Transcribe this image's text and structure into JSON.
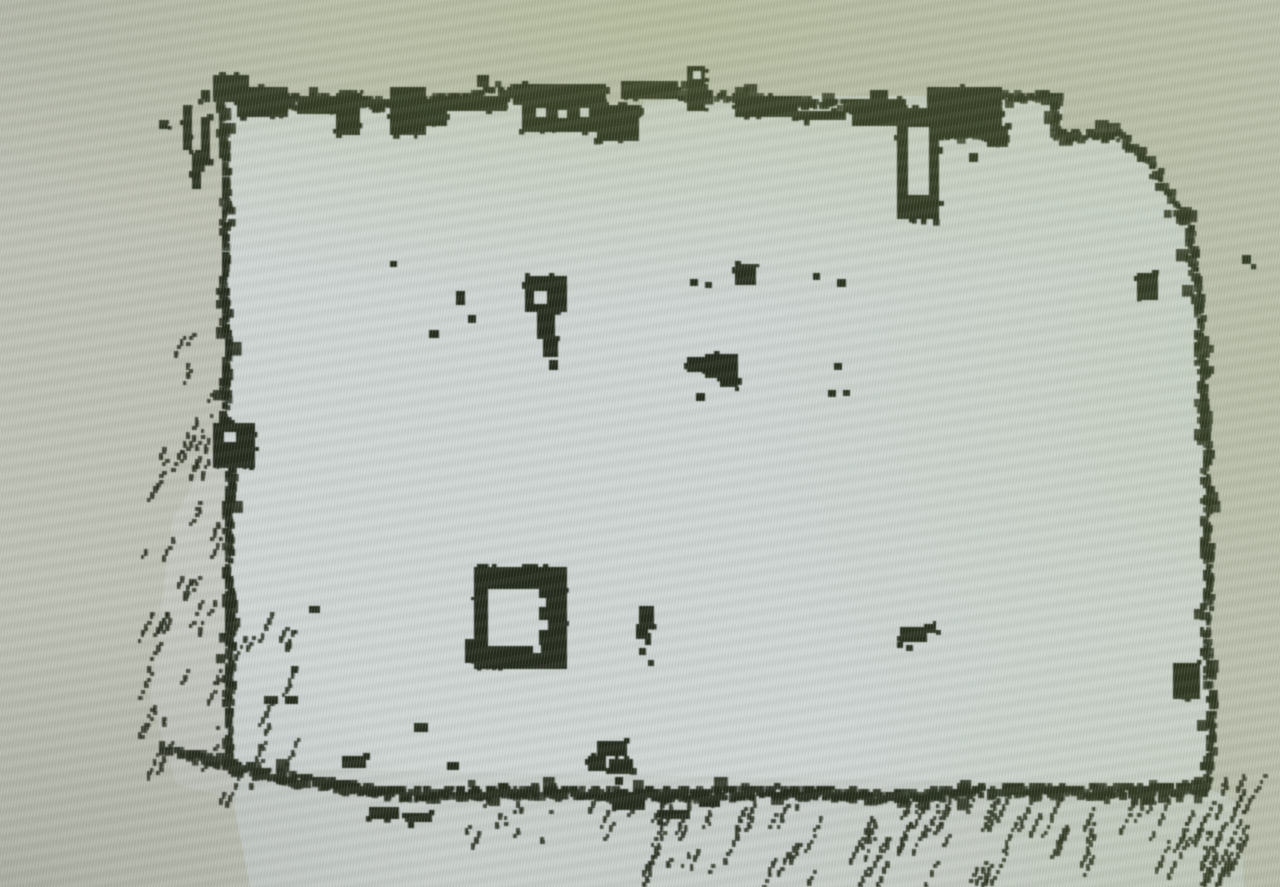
{
  "scene": {
    "kind": "photograph of a monitor showing a lidar occupancy-grid map",
    "visible_text": []
  },
  "map": {
    "width": 1280,
    "height": 887,
    "seed": 11,
    "colors": {
      "unknown": "#bfc2b6",
      "free_main": "#cfd6d4",
      "free_dim": "#c9cfcb",
      "wedge": "#c6c9c2",
      "obstacle": "#232a1b"
    },
    "free_regions": [
      {
        "name": "room-interior",
        "color": "free_main",
        "points": [
          [
            227,
            98
          ],
          [
            644,
            104
          ],
          [
            688,
            96
          ],
          [
            1004,
            96
          ],
          [
            1062,
            94
          ],
          [
            1062,
            132
          ],
          [
            1122,
            136
          ],
          [
            1152,
            170
          ],
          [
            1191,
            232
          ],
          [
            1203,
            340
          ],
          [
            1207,
            520
          ],
          [
            1211,
            700
          ],
          [
            1207,
            788
          ],
          [
            560,
            780
          ],
          [
            232,
            768
          ],
          [
            225,
            430
          ],
          [
            223,
            230
          ]
        ]
      },
      {
        "name": "below-wall-strip",
        "color": "free_dim",
        "points": [
          [
            230,
            768
          ],
          [
            1205,
            786
          ],
          [
            1240,
            804
          ],
          [
            1244,
            887
          ],
          [
            250,
            887
          ],
          [
            234,
            806
          ]
        ]
      },
      {
        "name": "left-seen-wedge",
        "color": "wedge",
        "points": [
          [
            225,
            428
          ],
          [
            232,
            770
          ],
          [
            237,
            800
          ],
          [
            176,
            784
          ],
          [
            150,
            696
          ],
          [
            172,
            520
          ]
        ]
      }
    ],
    "walls": [
      {
        "name": "top-wall-west",
        "thickness": 13,
        "points": [
          [
            222,
            96
          ],
          [
            262,
            94
          ],
          [
            302,
            104
          ],
          [
            346,
            99
          ],
          [
            402,
            110
          ],
          [
            456,
            99
          ],
          [
            518,
            93
          ],
          [
            556,
            116
          ],
          [
            602,
            120
          ],
          [
            642,
            112
          ]
        ]
      },
      {
        "name": "top-wall-east",
        "thickness": 10,
        "points": [
          [
            688,
            93
          ],
          [
            745,
            100
          ],
          [
            808,
            102
          ],
          [
            862,
            106
          ],
          [
            902,
            112
          ]
        ]
      },
      {
        "name": "notch-dash",
        "thickness": 8,
        "points": [
          [
            944,
            136
          ],
          [
            1006,
            136
          ]
        ]
      },
      {
        "name": "notch-top",
        "thickness": 8,
        "points": [
          [
            1006,
            97
          ],
          [
            1060,
            97
          ]
        ]
      },
      {
        "name": "notch-drop",
        "thickness": 9,
        "points": [
          [
            1056,
            97
          ],
          [
            1056,
            132
          ]
        ]
      },
      {
        "name": "notch-shelf",
        "thickness": 8,
        "points": [
          [
            1056,
            136
          ],
          [
            1120,
            137
          ]
        ]
      },
      {
        "name": "topright-diagonal",
        "thickness": 10,
        "points": [
          [
            1120,
            137
          ],
          [
            1149,
            163
          ],
          [
            1173,
            200
          ],
          [
            1190,
            232
          ]
        ]
      },
      {
        "name": "left-wall-upper",
        "thickness": 7,
        "points": [
          [
            222,
            96
          ],
          [
            226,
            180
          ],
          [
            224,
            262
          ],
          [
            227,
            344
          ],
          [
            225,
            422
          ]
        ]
      },
      {
        "name": "left-wall-lower",
        "thickness": 7,
        "points": [
          [
            225,
            422
          ],
          [
            233,
            452
          ],
          [
            228,
            522
          ],
          [
            230,
            602
          ],
          [
            229,
            692
          ],
          [
            229,
            766
          ]
        ]
      },
      {
        "name": "right-wall",
        "thickness": 10,
        "points": [
          [
            1190,
            232
          ],
          [
            1199,
            302
          ],
          [
            1202,
            372
          ],
          [
            1205,
            442
          ],
          [
            1207,
            512
          ],
          [
            1209,
            582
          ],
          [
            1206,
            650
          ],
          [
            1212,
            702
          ],
          [
            1208,
            786
          ]
        ]
      },
      {
        "name": "bottom-wall",
        "thickness": 12,
        "points": [
          [
            229,
            766
          ],
          [
            290,
            779
          ],
          [
            400,
            796
          ],
          [
            500,
            792
          ],
          [
            640,
            795
          ],
          [
            780,
            792
          ],
          [
            900,
            797
          ],
          [
            1020,
            790
          ],
          [
            1120,
            792
          ],
          [
            1203,
            787
          ]
        ]
      },
      {
        "name": "bottomleft-spur",
        "thickness": 7,
        "points": [
          [
            162,
            751
          ],
          [
            200,
            756
          ],
          [
            230,
            768
          ]
        ]
      }
    ],
    "obstacle_blobs": [
      [
        212,
        76,
        36,
        26
      ],
      [
        238,
        86,
        50,
        30
      ],
      [
        298,
        96,
        44,
        18
      ],
      [
        336,
        92,
        24,
        42
      ],
      [
        390,
        88,
        36,
        48
      ],
      [
        422,
        98,
        24,
        28
      ],
      [
        444,
        96,
        62,
        15
      ],
      [
        478,
        75,
        13,
        13
      ],
      [
        514,
        85,
        92,
        22
      ],
      [
        521,
        101,
        88,
        31
      ],
      [
        597,
        106,
        42,
        36
      ],
      [
        622,
        82,
        58,
        17
      ],
      [
        686,
        83,
        18,
        26
      ],
      [
        735,
        96,
        64,
        20
      ],
      [
        798,
        112,
        48,
        10
      ],
      [
        852,
        100,
        54,
        28
      ],
      [
        871,
        90,
        18,
        13
      ],
      [
        926,
        86,
        76,
        50
      ],
      [
        988,
        126,
        22,
        20
      ],
      [
        182,
        106,
        9,
        46
      ],
      [
        192,
        152,
        8,
        36
      ],
      [
        202,
        116,
        8,
        46
      ],
      [
        160,
        119,
        8,
        8
      ],
      [
        202,
        91,
        8,
        8
      ],
      [
        214,
        423,
        42,
        44
      ],
      [
        1174,
        662,
        28,
        36
      ],
      [
        1138,
        272,
        20,
        28
      ],
      [
        1242,
        256,
        10,
        10
      ],
      [
        524,
        276,
        42,
        37
      ],
      [
        538,
        310,
        17,
        29
      ],
      [
        544,
        338,
        15,
        19
      ],
      [
        736,
        263,
        21,
        21
      ],
      [
        686,
        357,
        19,
        14
      ],
      [
        704,
        353,
        34,
        25
      ],
      [
        720,
        375,
        17,
        12
      ],
      [
        639,
        605,
        15,
        21
      ],
      [
        635,
        624,
        12,
        16
      ],
      [
        901,
        628,
        28,
        14
      ],
      [
        924,
        624,
        13,
        10
      ],
      [
        596,
        742,
        30,
        15
      ],
      [
        588,
        755,
        18,
        15
      ],
      [
        608,
        759,
        24,
        16
      ],
      [
        613,
        796,
        32,
        15
      ],
      [
        660,
        811,
        30,
        10
      ],
      [
        698,
        799,
        22,
        9
      ],
      [
        370,
        806,
        30,
        12
      ],
      [
        404,
        814,
        28,
        10
      ],
      [
        343,
        755,
        24,
        11
      ],
      [
        688,
        67,
        19,
        17
      ]
    ],
    "pillar": {
      "outer": [
        898,
        109,
        42,
        112
      ],
      "inner": [
        908,
        127,
        21,
        68
      ]
    },
    "box_obstacle": {
      "outer": [
        473,
        567,
        92,
        102
      ],
      "inner": [
        488,
        589,
        51,
        57
      ],
      "foot": [
        466,
        638,
        14,
        24
      ]
    },
    "free_notches": [
      [
        644,
        101,
        40,
        46
      ],
      [
        536,
        108,
        10,
        9
      ],
      [
        558,
        110,
        9,
        8
      ],
      [
        580,
        108,
        9,
        9
      ],
      [
        534,
        291,
        13,
        13
      ],
      [
        224,
        432,
        12,
        10
      ],
      [
        693,
        71,
        8,
        8
      ],
      [
        537,
        598,
        9,
        9
      ],
      [
        539,
        620,
        9,
        10
      ],
      [
        533,
        645,
        8,
        8
      ]
    ],
    "dots": [
      [
        390,
        261,
        7,
        6
      ],
      [
        456,
        291,
        9,
        14
      ],
      [
        468,
        316,
        8,
        8
      ],
      [
        428,
        331,
        10,
        8
      ],
      [
        548,
        360,
        9,
        10
      ],
      [
        689,
        278,
        8,
        7
      ],
      [
        704,
        282,
        7,
        6
      ],
      [
        813,
        273,
        7,
        7
      ],
      [
        836,
        280,
        9,
        8
      ],
      [
        696,
        394,
        9,
        8
      ],
      [
        834,
        364,
        8,
        7
      ],
      [
        828,
        390,
        8,
        7
      ],
      [
        842,
        391,
        7,
        6
      ],
      [
        970,
        153,
        9,
        9
      ],
      [
        640,
        647,
        7,
        7
      ],
      [
        648,
        661,
        6,
        6
      ],
      [
        907,
        645,
        7,
        6
      ],
      [
        615,
        777,
        8,
        8
      ],
      [
        264,
        696,
        14,
        8
      ],
      [
        285,
        696,
        13,
        8
      ],
      [
        413,
        723,
        14,
        9
      ],
      [
        446,
        763,
        12,
        8
      ],
      [
        308,
        606,
        11,
        7
      ],
      [
        290,
        666,
        7,
        7
      ],
      [
        229,
        473,
        8,
        24
      ]
    ],
    "hatch_fields": [
      {
        "name": "below-bottom-wall-east",
        "x": [
          640,
          1235
        ],
        "y": [
          796,
          872
        ],
        "count": 95,
        "length": [
          14,
          46
        ]
      },
      {
        "name": "below-bottom-wall-mid",
        "x": [
          455,
          645
        ],
        "y": [
          798,
          848
        ],
        "count": 14,
        "length": [
          10,
          26
        ]
      },
      {
        "name": "outside-bottom-left",
        "x": [
          148,
          300
        ],
        "y": [
          612,
          796
        ],
        "count": 34,
        "length": [
          12,
          36
        ]
      },
      {
        "name": "outside-left-mid",
        "x": [
          143,
          222
        ],
        "y": [
          428,
          612
        ],
        "count": 24,
        "length": [
          10,
          30
        ]
      },
      {
        "name": "beyond-bottomright-corner",
        "x": [
          1196,
          1262
        ],
        "y": [
          775,
          876
        ],
        "count": 20,
        "length": [
          12,
          36
        ]
      },
      {
        "name": "outside-left-upper",
        "x": [
          168,
          215
        ],
        "y": [
          330,
          425
        ],
        "count": 8,
        "length": [
          8,
          18
        ]
      }
    ]
  }
}
